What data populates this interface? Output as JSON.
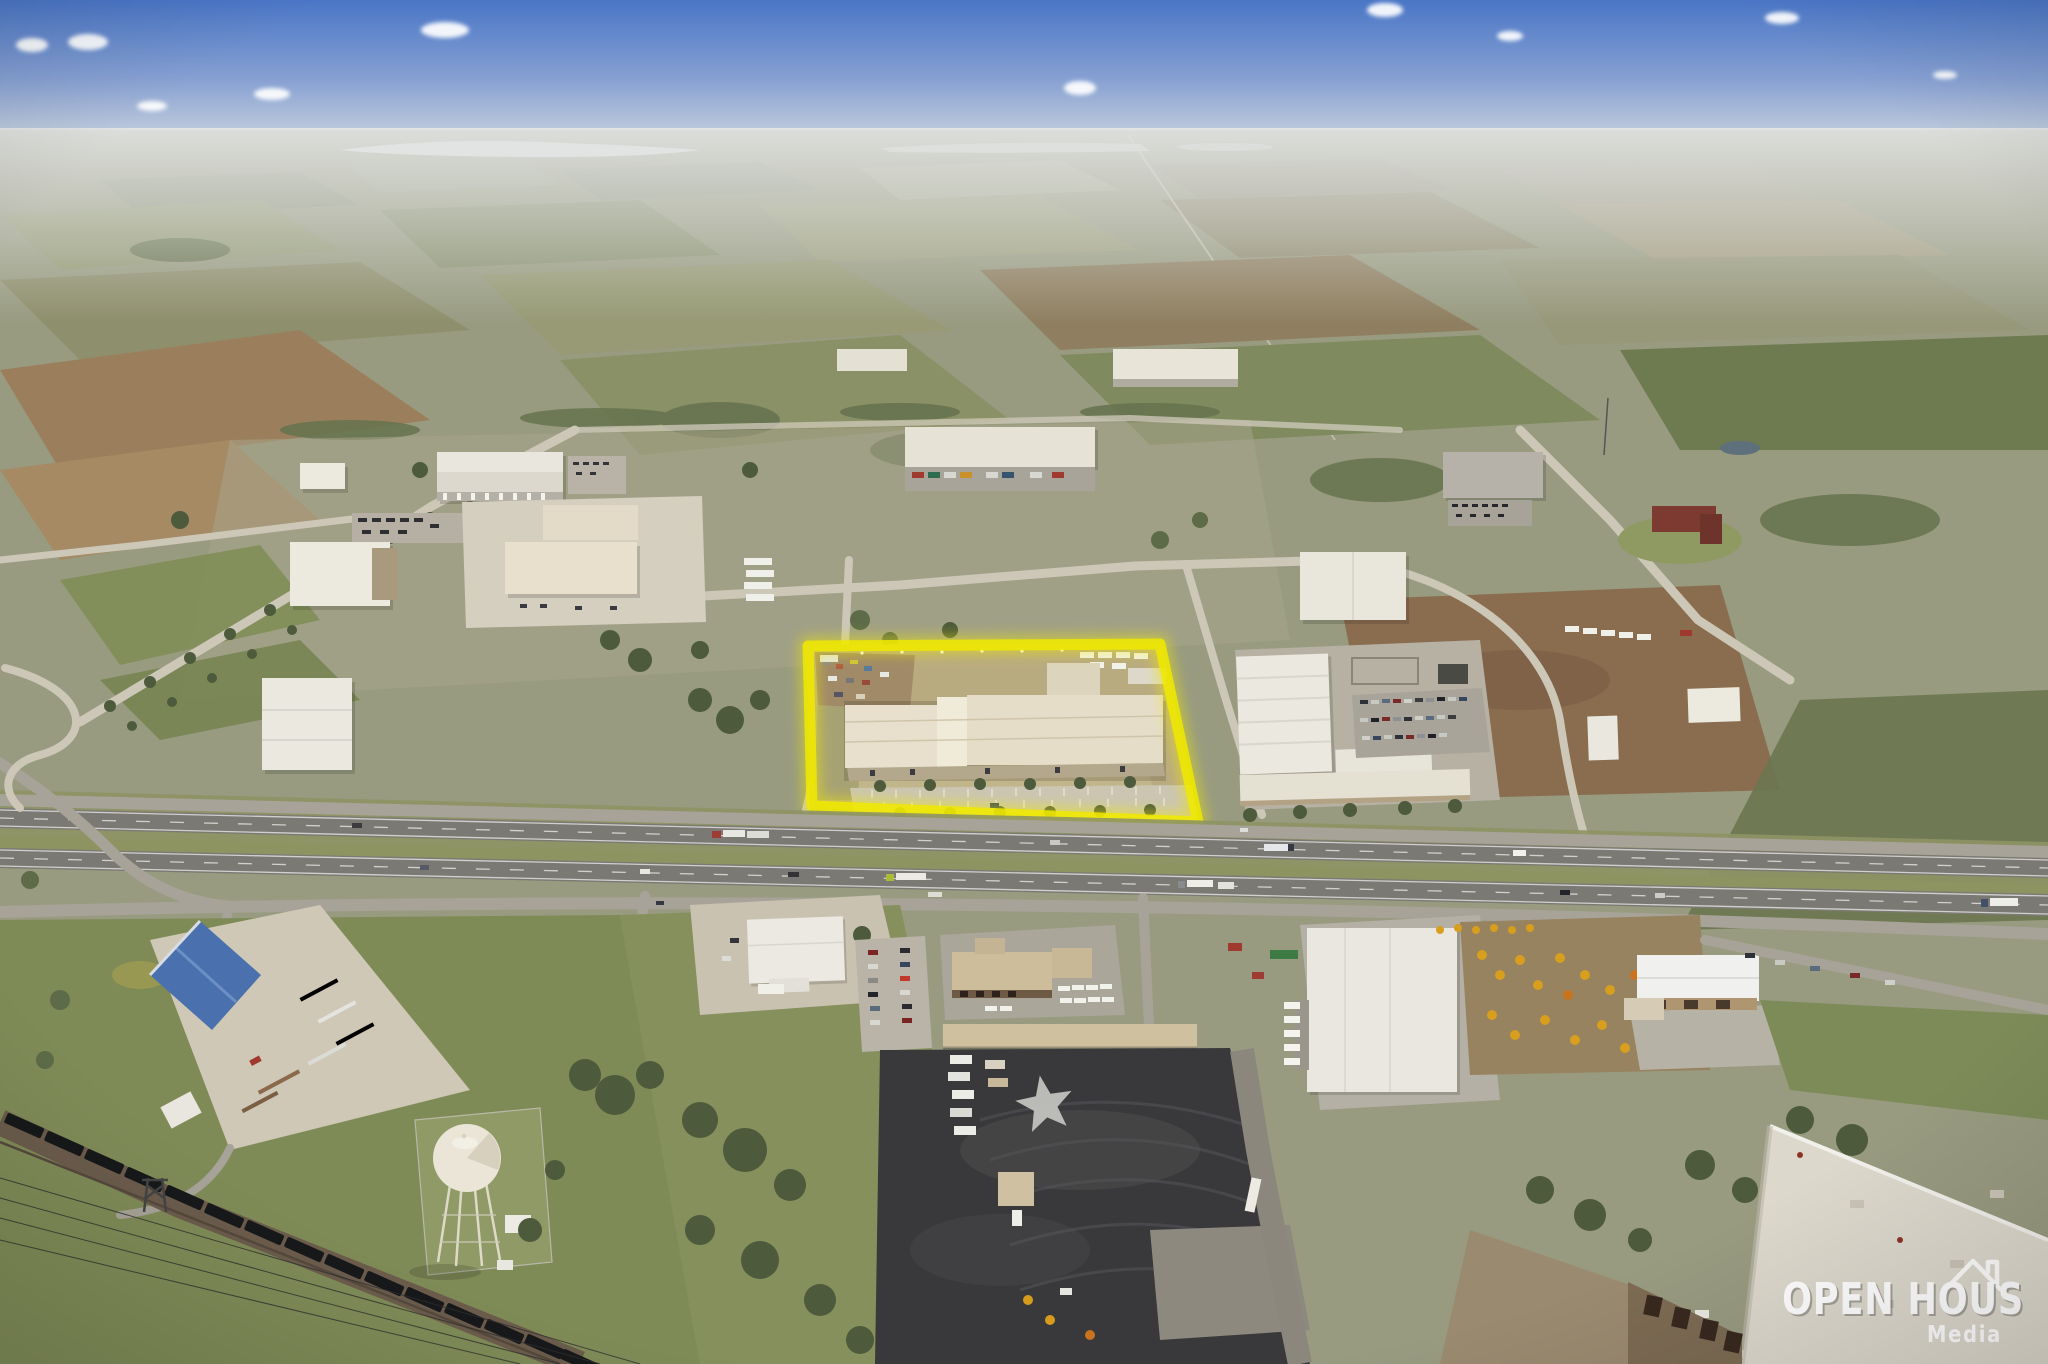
{
  "watermark": {
    "title": "OPEN HOUS",
    "subtitle": "Media",
    "icon": "house-roof-icon"
  },
  "highlight": {
    "color": "#f0e900"
  },
  "colors": {
    "highlight": "#f0e900",
    "logo": "#ffffff",
    "sky_top": "#4a76c6",
    "haze": "#d8dbdd",
    "field_olive": "#999c74",
    "dark_asphalt": "#39393b",
    "warehouse_roof": "#e8e0cc",
    "water_tower": "#eae5d6",
    "blue_roof": "#4a71ad"
  }
}
